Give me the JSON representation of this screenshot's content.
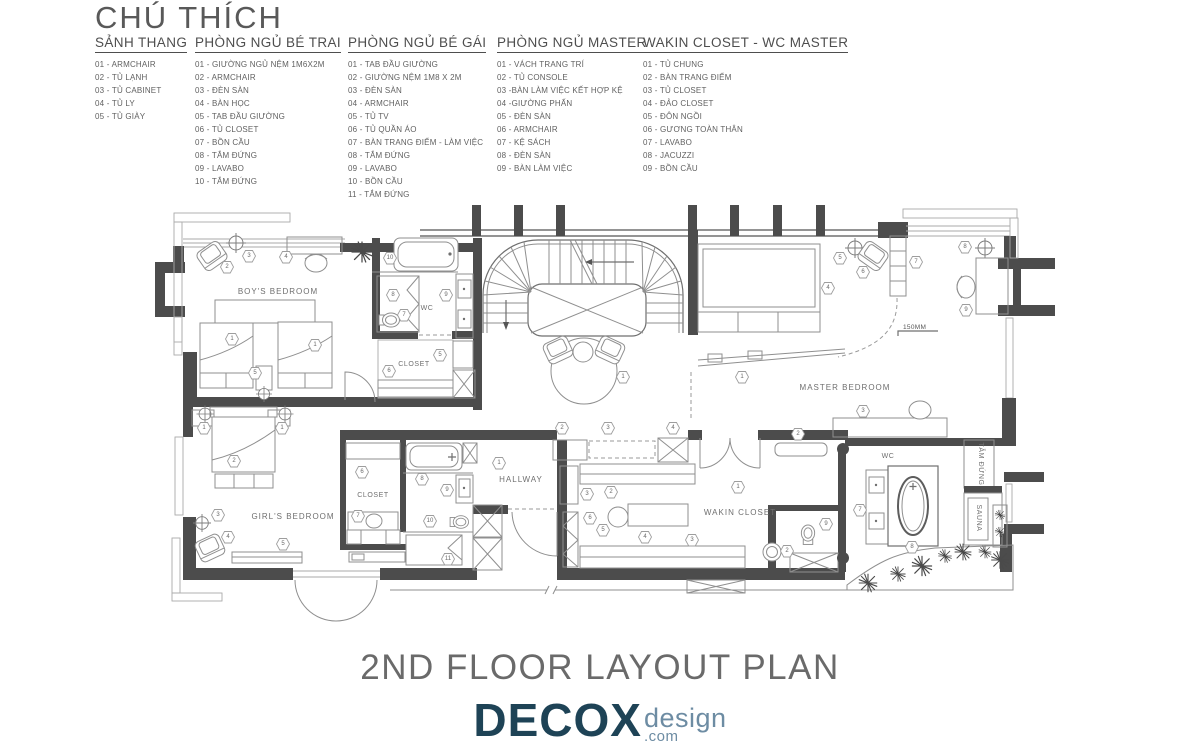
{
  "legend": {
    "title": "CHÚ THÍCH",
    "columns": [
      {
        "header": "SẢNH THANG",
        "items": [
          "01 - ARMCHAIR",
          "02 - TỦ LẠNH",
          "03 - TỦ CABINET",
          "04 - TỦ LY",
          "05 - TỦ GIÀY"
        ]
      },
      {
        "header": "PHÒNG NGỦ BÉ TRAI",
        "items": [
          "01 - GIƯỜNG NGỦ NỆM 1M6X2M",
          "02 - ARMCHAIR",
          "03 - ĐÈN SÀN",
          "04 - BÀN HỌC",
          "05 - TAB ĐẦU GIƯỜNG",
          "06 - TỦ CLOSET",
          "07 - BỒN CẦU",
          "08 - TẮM ĐỨNG",
          "09 - LAVABO",
          "10 - TẮM ĐỨNG"
        ]
      },
      {
        "header": "PHÒNG NGỦ BÉ GÁI",
        "items": [
          "01 - TAB ĐẦU GIƯỜNG",
          "02 - GIƯỜNG NỆM 1M8 X 2M",
          "03 - ĐÈN SÀN",
          "04 - ARMCHAIR",
          "05 - TỦ TV",
          "06 - TỦ QUẦN ÁO",
          "07 - BÀN TRANG ĐIỂM - LÀM VIỆC",
          "08 - TẮM ĐỨNG",
          "09 - LAVABO",
          "10 - BỒN CẦU",
          "11 - TẮM ĐỨNG"
        ]
      },
      {
        "header": "PHÒNG NGỦ MASTER",
        "items": [
          "01 - VÁCH TRANG TRÍ",
          "02 - TỦ CONSOLE",
          "03 -BÀN LÀM VIỆC KẾT HỢP KỆ",
          "04 -GIƯỜNG PHẤN",
          "05 - ĐÈN SÀN",
          "06 - ARMCHAIR",
          "07 - KỆ SÁCH",
          "08 - ĐÈN SÀN",
          "09 - BÀN LÀM VIỆC"
        ]
      },
      {
        "header": "WAKIN CLOSET - WC MASTER",
        "items": [
          "01 - TỦ CHUNG",
          "02 - BÀN TRANG ĐIỂM",
          "03 - TỦ CLOSET",
          "04 - ĐẢO CLOSET",
          "05 - ĐÔN NGỒI",
          "06 - GƯƠNG TOÀN THÂN",
          "07 - LAVABO",
          "08 - JACUZZI",
          "09 - BỒN CẦU"
        ]
      }
    ]
  },
  "plan": {
    "labels": {
      "boys_bedroom": "BOY'S BEDROOM",
      "boys_wc": "WC",
      "boys_closet": "CLOSET",
      "girls_bedroom": "GIRL'S BEDROOM",
      "girls_closet": "CLOSET",
      "hallway": "HALLWAY",
      "wakin_closet": "WAKIN CLOSET",
      "master_bedroom": "MASTER BEDROOM",
      "master_wc": "WC",
      "tam_dung": "TẮM ĐỨNG",
      "sauna": "SAUNA",
      "step_note": "150MM"
    },
    "markers": [
      [
        2,
        227,
        267
      ],
      [
        3,
        249,
        256
      ],
      [
        4,
        286,
        257
      ],
      [
        1,
        232,
        339
      ],
      [
        1,
        315,
        345
      ],
      [
        5,
        255,
        373
      ],
      [
        10,
        390,
        258
      ],
      [
        8,
        393,
        295
      ],
      [
        7,
        404,
        315
      ],
      [
        9,
        446,
        295
      ],
      [
        5,
        440,
        355
      ],
      [
        6,
        389,
        371
      ],
      [
        1,
        623,
        377
      ],
      [
        1,
        499,
        463
      ],
      [
        1,
        204,
        428
      ],
      [
        1,
        282,
        428
      ],
      [
        2,
        234,
        461
      ],
      [
        3,
        218,
        515
      ],
      [
        4,
        228,
        537
      ],
      [
        5,
        283,
        544
      ],
      [
        6,
        362,
        472
      ],
      [
        7,
        358,
        516
      ],
      [
        8,
        422,
        479
      ],
      [
        9,
        447,
        490
      ],
      [
        10,
        430,
        521
      ],
      [
        11,
        448,
        559
      ],
      [
        2,
        562,
        428
      ],
      [
        3,
        608,
        428
      ],
      [
        4,
        673,
        428
      ],
      [
        2,
        611,
        492
      ],
      [
        3,
        587,
        494
      ],
      [
        6,
        590,
        518
      ],
      [
        5,
        603,
        530
      ],
      [
        4,
        645,
        537
      ],
      [
        3,
        692,
        540
      ],
      [
        1,
        738,
        487
      ],
      [
        5,
        840,
        258
      ],
      [
        6,
        863,
        272
      ],
      [
        7,
        916,
        262
      ],
      [
        8,
        965,
        247
      ],
      [
        9,
        966,
        310
      ],
      [
        4,
        828,
        288
      ],
      [
        1,
        742,
        377
      ],
      [
        2,
        798,
        434
      ],
      [
        3,
        863,
        411
      ],
      [
        7,
        860,
        510
      ],
      [
        8,
        912,
        547
      ],
      [
        9,
        826,
        524
      ],
      [
        2,
        787,
        551
      ]
    ]
  },
  "title": {
    "text": "2ND FLOOR LAYOUT PLAN"
  },
  "logo": {
    "brand": "DECOX",
    "word": "design",
    "domain": ".com"
  }
}
